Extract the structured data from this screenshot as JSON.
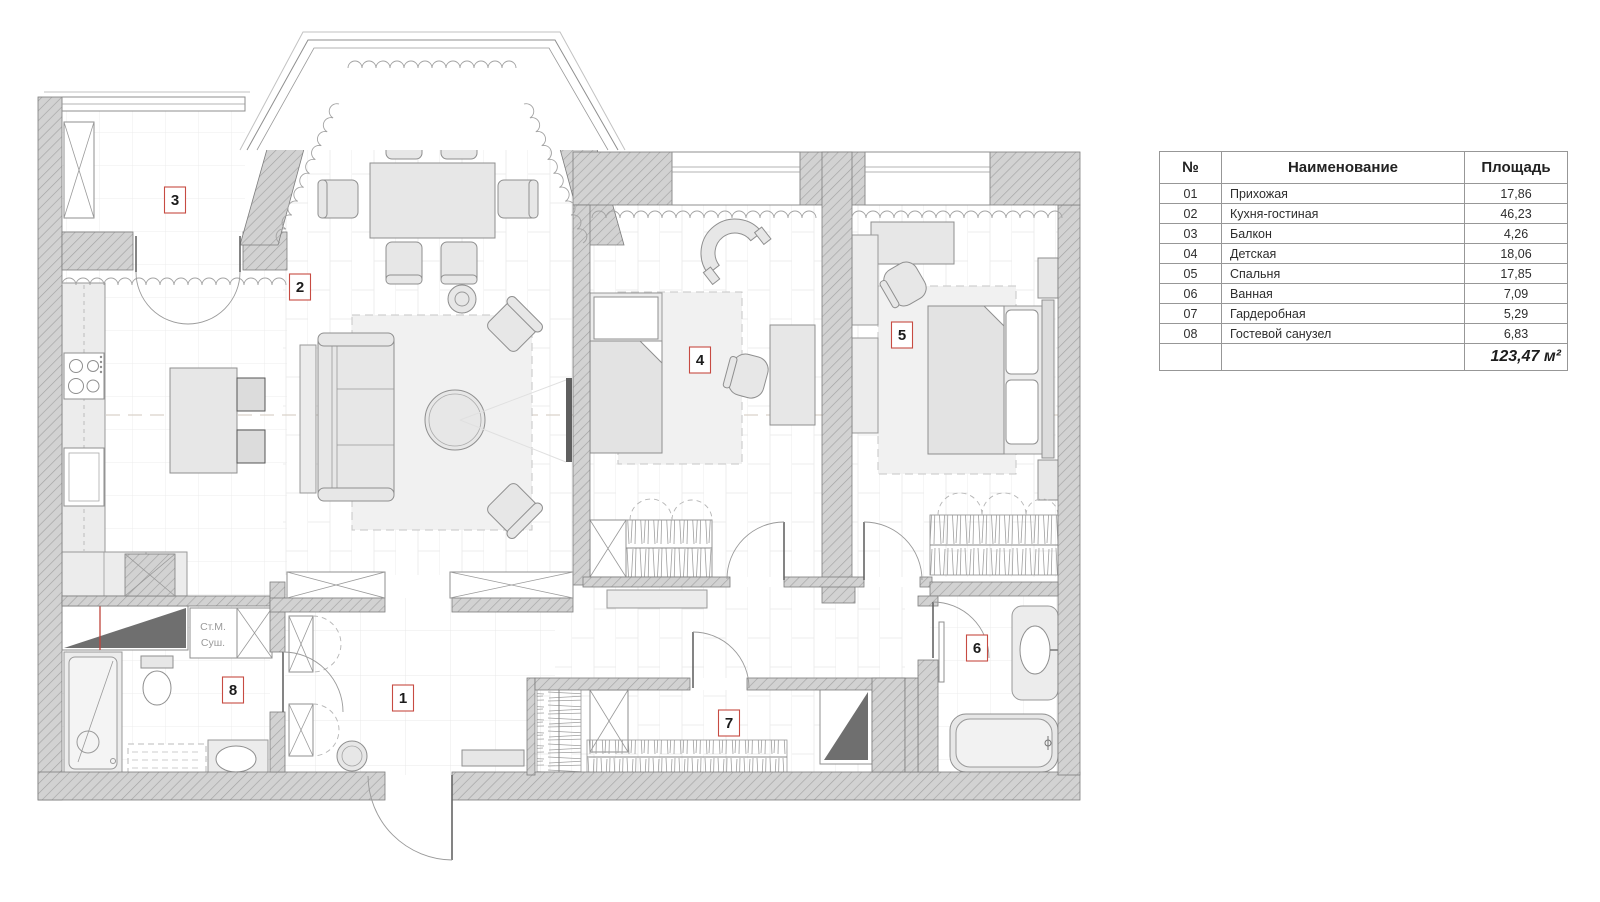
{
  "legend": {
    "headers": {
      "num": "№",
      "name": "Наименование",
      "area": "Площадь"
    },
    "rows": [
      {
        "num": "01",
        "name": "Прихожая",
        "area": "17,86"
      },
      {
        "num": "02",
        "name": "Кухня-гостиная",
        "area": "46,23"
      },
      {
        "num": "03",
        "name": "Балкон",
        "area": "4,26"
      },
      {
        "num": "04",
        "name": "Детская",
        "area": "18,06"
      },
      {
        "num": "05",
        "name": "Спальня",
        "area": "17,85"
      },
      {
        "num": "06",
        "name": "Ванная",
        "area": "7,09"
      },
      {
        "num": "07",
        "name": "Гардеробная",
        "area": "5,29"
      },
      {
        "num": "08",
        "name": "Гостевой санузел",
        "area": "6,83"
      }
    ],
    "total": "123,47 м²"
  },
  "plan": {
    "rooms": [
      {
        "num": "1",
        "label": "Прихожая",
        "x": 403,
        "y": 698
      },
      {
        "num": "2",
        "label": "Кухня-гостиная",
        "x": 300,
        "y": 287
      },
      {
        "num": "3",
        "label": "Балкон",
        "x": 175,
        "y": 200
      },
      {
        "num": "4",
        "label": "Детская",
        "x": 700,
        "y": 360
      },
      {
        "num": "5",
        "label": "Спальня",
        "x": 902,
        "y": 335
      },
      {
        "num": "6",
        "label": "Ванная",
        "x": 977,
        "y": 648
      },
      {
        "num": "7",
        "label": "Гардеробная",
        "x": 729,
        "y": 723
      },
      {
        "num": "8",
        "label": "Гостевой санузел",
        "x": 233,
        "y": 690
      }
    ],
    "appliances": {
      "line1": "Ст.М.",
      "line2": "Суш."
    }
  },
  "colors": {
    "wall_fill": "#d2d2d2",
    "wall_hatch": "#a3a3a3",
    "marker_border": "#c74b42",
    "axis_dash": "#d9d2c9",
    "dark_shaft": "#6f6f6f",
    "red_line": "#c0443c"
  }
}
